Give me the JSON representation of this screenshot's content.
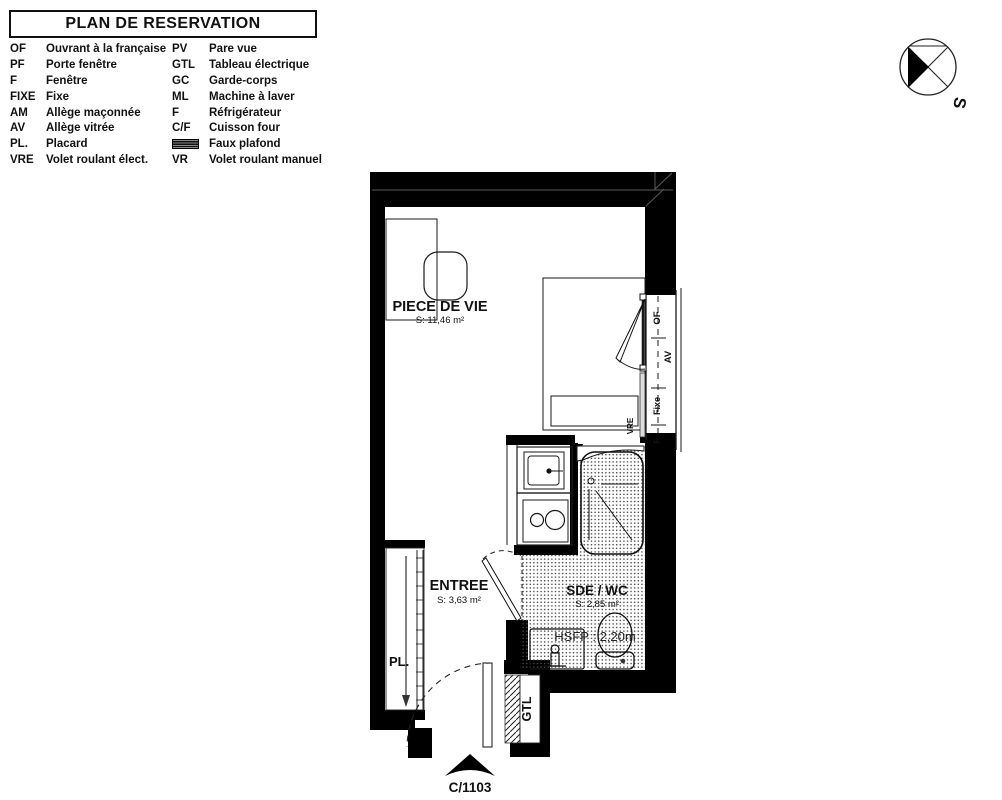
{
  "title": "PLAN DE RESERVATION",
  "legend": {
    "left": [
      {
        "abbr": "OF",
        "label": "Ouvrant à la française"
      },
      {
        "abbr": "PF",
        "label": "Porte fenêtre"
      },
      {
        "abbr": "F",
        "label": "Fenêtre"
      },
      {
        "abbr": "FIXE",
        "label": "Fixe"
      },
      {
        "abbr": "AM",
        "label": "Allège maçonnée"
      },
      {
        "abbr": "AV",
        "label": "Allège vitrée"
      },
      {
        "abbr": "PL.",
        "label": "Placard"
      },
      {
        "abbr": "VRE",
        "label": "Volet roulant élect."
      }
    ],
    "right": [
      {
        "abbr": "PV",
        "label": "Pare vue"
      },
      {
        "abbr": "GTL",
        "label": "Tableau électrique"
      },
      {
        "abbr": "GC",
        "label": "Garde-corps"
      },
      {
        "abbr": "ML",
        "label": "Machine à laver"
      },
      {
        "abbr": "F",
        "label": "Réfrigérateur"
      },
      {
        "abbr": "C/F",
        "label": "Cuisson four"
      },
      {
        "abbr": "",
        "label": "Faux plafond"
      },
      {
        "abbr": "VR",
        "label": "Volet roulant manuel"
      }
    ]
  },
  "compass": {
    "label": "S"
  },
  "plan": {
    "piece_de_vie": {
      "name": "PIECE DE VIE",
      "area": "S: 11,46 m²"
    },
    "entree": {
      "name": "ENTREE",
      "area": "S: 3,63 m²"
    },
    "sde_wc": {
      "name": "SDE / WC",
      "area": "S: 2,85 m²",
      "ceiling_height": "HSFP : 2,20m"
    },
    "window": {
      "of": "OF",
      "av": "AV",
      "fixe": "Fixe",
      "f": "F",
      "vre": "VRE"
    },
    "placard": "PL.",
    "gtl": "GTL",
    "unit_ref": "C/1103"
  },
  "colors": {
    "wall": "#000000",
    "line": "#1a1a1a",
    "dots": "#4a4a4a",
    "paper": "#ffffff"
  }
}
